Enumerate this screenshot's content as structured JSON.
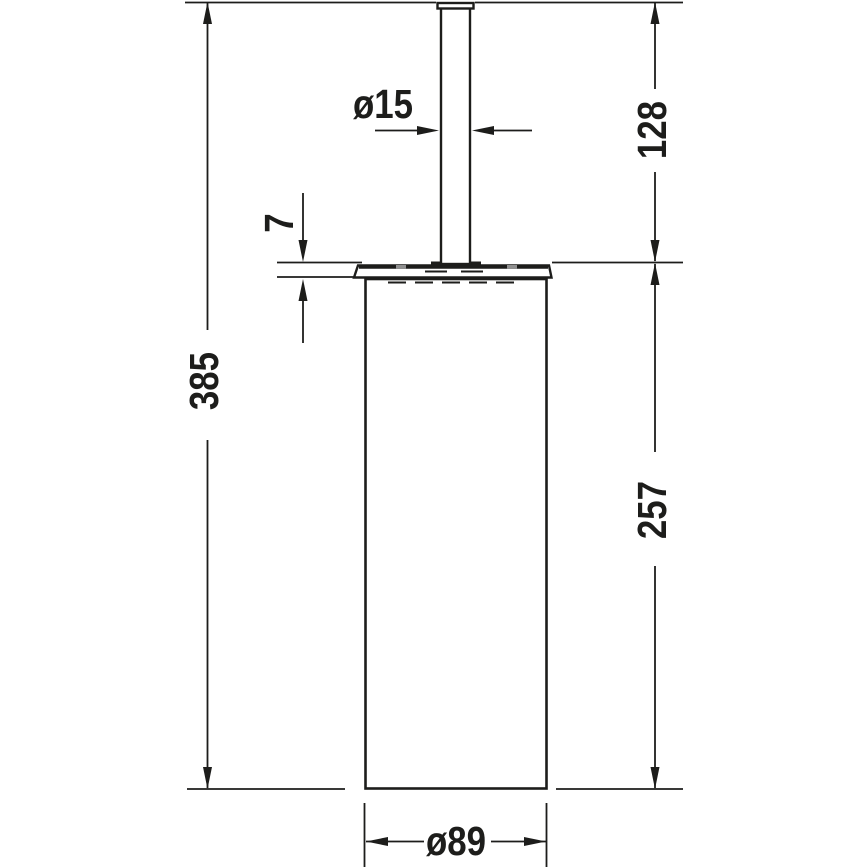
{
  "page": {
    "background": "#ffffff"
  },
  "drawing": {
    "kind": "technical-dimension-drawing",
    "line_color": "#1d1d1b",
    "labels": {
      "total_height": "385",
      "handle_height": "128",
      "body_height": "257",
      "lid_thickness": "7",
      "handle_diameter": "ø15",
      "body_diameter": "ø89"
    }
  }
}
